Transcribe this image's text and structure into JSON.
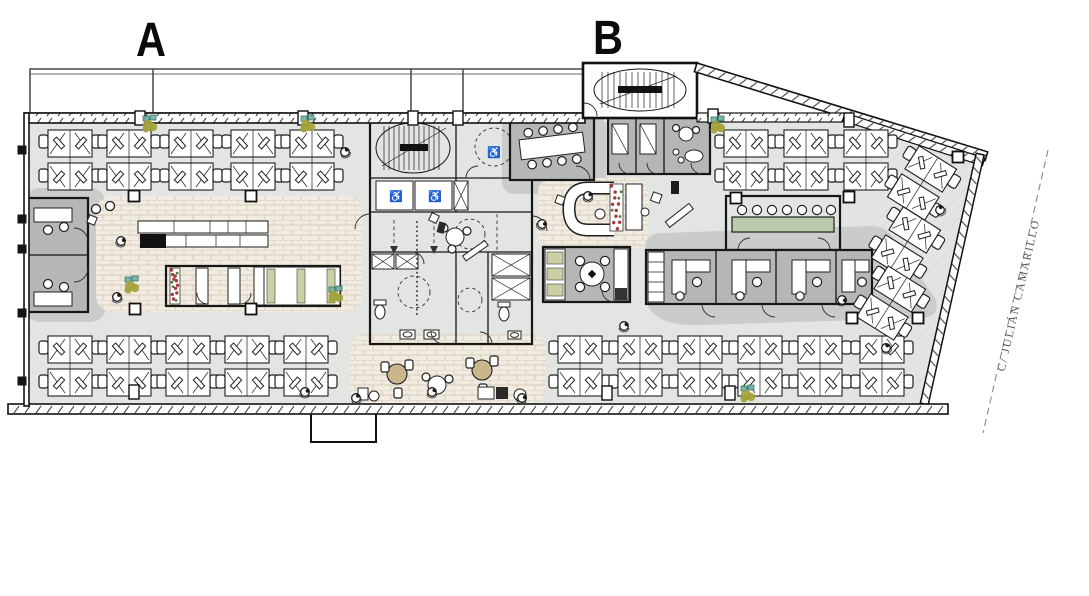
{
  "labels": {
    "section_a": "A",
    "section_b": "B",
    "street_name": "C/ JULIÁN CAMARILLO"
  },
  "icons": {
    "wheelchair": "♿"
  },
  "colors": {
    "wall": "#161616",
    "floor": "#e3e5e2",
    "floor_line": "#d8dad7",
    "room": "#b4b7b4",
    "shadow": "#c9ccc9",
    "brick_bg": "#f1ebe1",
    "brick_line": "#d9cdbb",
    "olive": "#a4a23b",
    "teal": "#6fb3aa",
    "red": "#a83a3a",
    "green": "#4e7c3c",
    "tan": "#c9b78b",
    "khaki": "#cccfa3",
    "table_green": "#b9cbaa",
    "street": "#555555"
  },
  "plan": {
    "areas": [
      "open-office-a",
      "open-office-b",
      "stair-core-a",
      "stair-core-b",
      "elevators",
      "restrooms",
      "kitchen-cafe",
      "booth-seating",
      "private-offices",
      "meeting-room-large",
      "phone-booths",
      "green-meeting-room",
      "meeting-rooms-row",
      "lunch-room",
      "lounge-sofa",
      "cafe-terrace",
      "balcony",
      "street"
    ],
    "desk_clusters": [
      [
        70,
        160,
        0
      ],
      [
        129,
        160,
        0
      ],
      [
        191,
        160,
        0
      ],
      [
        253,
        160,
        0
      ],
      [
        312,
        160,
        0
      ],
      [
        70,
        366,
        0
      ],
      [
        129,
        366,
        0
      ],
      [
        188,
        366,
        0
      ],
      [
        247,
        366,
        0
      ],
      [
        306,
        366,
        0
      ],
      [
        746,
        160,
        0
      ],
      [
        806,
        160,
        0
      ],
      [
        866,
        160,
        0
      ],
      [
        580,
        366,
        0
      ],
      [
        640,
        366,
        0
      ],
      [
        700,
        366,
        0
      ],
      [
        760,
        366,
        0
      ],
      [
        820,
        366,
        0
      ],
      [
        882,
        366,
        0
      ],
      [
        922,
        183,
        32
      ],
      [
        906,
        244,
        32
      ],
      [
        891,
        303,
        32
      ]
    ],
    "columns": [
      [
        134,
        196
      ],
      [
        251,
        196
      ],
      [
        135,
        309
      ],
      [
        251,
        309
      ],
      [
        736,
        198
      ],
      [
        849,
        197
      ],
      [
        958,
        157
      ],
      [
        852,
        318
      ],
      [
        918,
        318
      ]
    ],
    "wall_pillars": [
      [
        140,
        118
      ],
      [
        303,
        118
      ],
      [
        413,
        118
      ],
      [
        458,
        118
      ],
      [
        713,
        116
      ],
      [
        849,
        120
      ],
      [
        134,
        392
      ],
      [
        607,
        393
      ],
      [
        730,
        393
      ]
    ],
    "wall_squares": [
      [
        22,
        150
      ],
      [
        22,
        219
      ],
      [
        22,
        249
      ],
      [
        22,
        313
      ],
      [
        22,
        381
      ]
    ],
    "plants": [
      [
        150,
        126
      ],
      [
        308,
        126
      ],
      [
        718,
        127
      ],
      [
        132,
        287
      ],
      [
        336,
        297
      ],
      [
        748,
        396
      ]
    ],
    "red_planters": [
      [
        170,
        268,
        10,
        36
      ],
      [
        610,
        184,
        13,
        47
      ]
    ],
    "people": [
      [
        345,
        152,
        -20
      ],
      [
        588,
        196,
        0
      ],
      [
        542,
        224,
        30
      ],
      [
        624,
        326,
        0
      ],
      [
        842,
        300,
        40
      ],
      [
        886,
        348,
        -30
      ],
      [
        305,
        392,
        10
      ],
      [
        356,
        398,
        -15
      ],
      [
        432,
        392,
        0
      ],
      [
        522,
        398,
        20
      ],
      [
        940,
        210,
        -40
      ],
      [
        121,
        241,
        15
      ],
      [
        117,
        297,
        -10
      ]
    ]
  }
}
